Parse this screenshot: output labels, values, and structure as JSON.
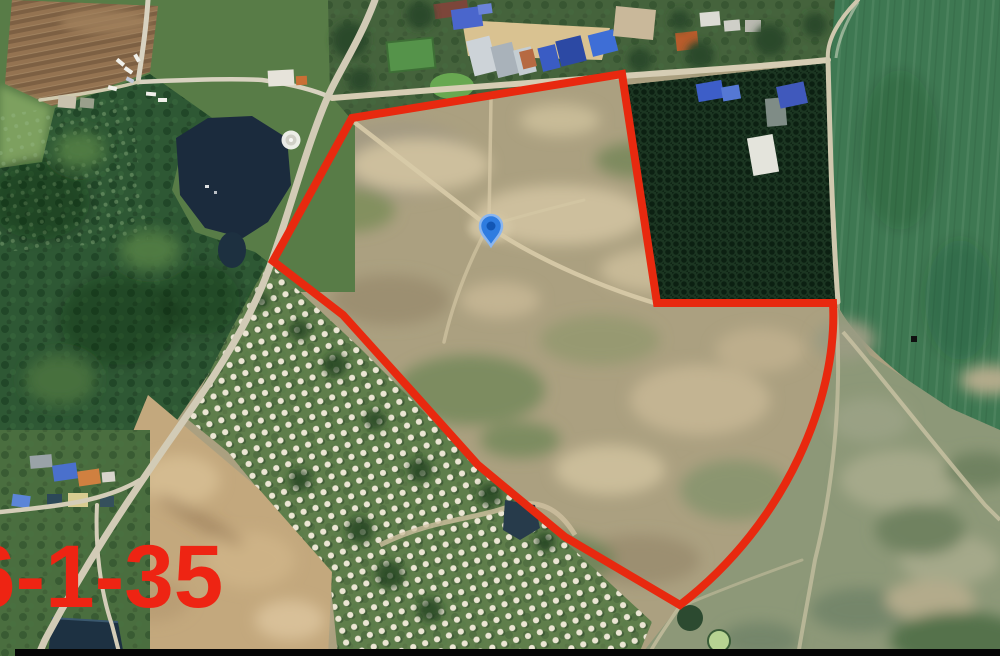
{
  "overlay": {
    "area_label": "6-1-35"
  },
  "colors": {
    "boundary": "#e8290f",
    "area-label": "#ee2413",
    "pin": "#2e7ce0",
    "pin-ring": "#8ab6f0",
    "pin-core": "#1256b4",
    "pond": "#1b2b3d",
    "field-green": "#3e7852",
    "plantation": "#1c3622",
    "letterbox": "#050505"
  },
  "markers": {
    "location_pin": {
      "x": 491,
      "y": 229
    },
    "poi_circle": {
      "x": 291,
      "y": 140
    }
  }
}
